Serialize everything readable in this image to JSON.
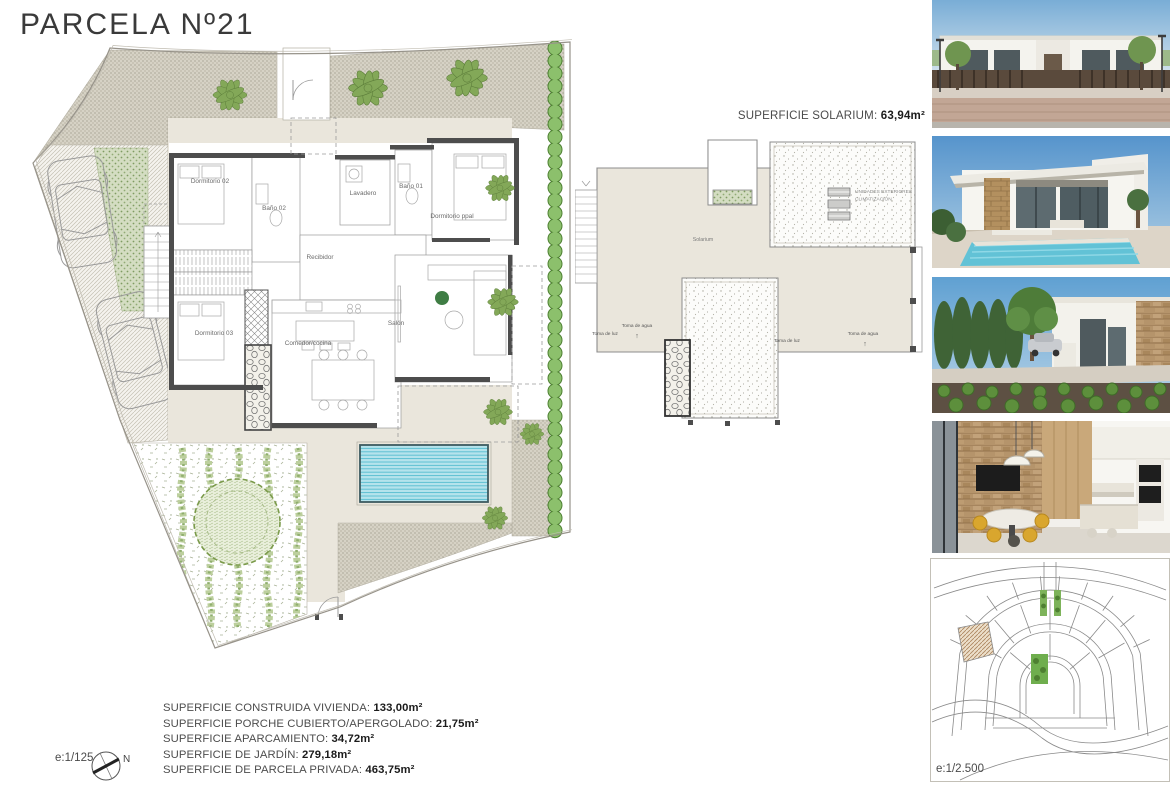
{
  "page": {
    "title": "PARCELA Nº21"
  },
  "main_plan": {
    "scale": "e:1/125",
    "north": "N",
    "rooms": {
      "dormitorio02": "Dormitorio 02",
      "bano02": "Baño 02",
      "lavadero": "Lavadero",
      "bano01": "Baño 01",
      "dormitorio_ppal": "Dormitorio ppal",
      "recibidor": "Recibidor",
      "dormitorio03": "Dormitorio 03",
      "comedor_cocina": "Comedor/cocina",
      "salon": "Salón"
    }
  },
  "solarium": {
    "heading_label": "SUPERFICIE SOLARIUM: ",
    "heading_value": "63,94m²",
    "room_label": "Solarium",
    "ac_line1": "UNIDADES EXTERIORES",
    "ac_line2": "CLIMATIZACIÓN",
    "toma_agua": "Toma de agua",
    "toma_luz": "Toma de luz",
    "arrow": "↑"
  },
  "areas": {
    "rows": [
      {
        "label": "SUPERFICIE CONSTRUIDA VIVIENDA: ",
        "value": "133,00m²"
      },
      {
        "label": "SUPERFICIE PORCHE CUBIERTO/APERGOLADO: ",
        "value": "21,75m²"
      },
      {
        "label": "SUPERFICIE APARCAMIENTO: ",
        "value": "34,72m²"
      },
      {
        "label": "SUPERFICIE DE JARDÍN: ",
        "value": "279,18m²"
      },
      {
        "label": "SUPERFICIE DE PARCELA PRIVADA: ",
        "value": "463,75m²"
      }
    ]
  },
  "site_map": {
    "scale": "e:1/2.500"
  },
  "photos": [
    {
      "name": "villa street view render"
    },
    {
      "name": "villa pool view render"
    },
    {
      "name": "villa garden view render"
    },
    {
      "name": "interior kitchen render"
    }
  ],
  "colors": {
    "beige": "#eae6dc",
    "wall_dark": "#4d4d4d",
    "hedge_green": "#8cc06c",
    "palm_green": "#83a858",
    "pool_cyan": "#b5e3ec",
    "gravel": "#d6d2c5"
  }
}
